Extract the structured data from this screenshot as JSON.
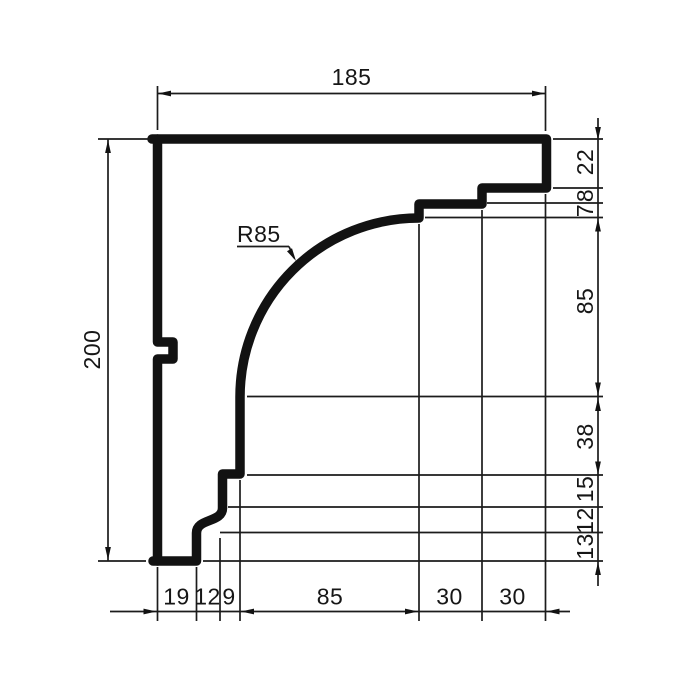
{
  "drawing": {
    "kind": "technical cross-section profile (cornice/moulding) with chain dimensions",
    "colors": {
      "line": "#121212",
      "background": "#ffffff"
    },
    "dimensions": {
      "total_width": 185,
      "total_height": 200,
      "radius": 85,
      "right_segments_top_to_bottom": [
        22,
        8,
        7,
        85,
        38,
        15,
        12,
        13
      ],
      "bottom_segments_left_to_right": [
        19,
        12,
        9,
        85,
        30,
        30
      ]
    }
  },
  "labels": {
    "width_total": "185",
    "height_total": "200",
    "radius": "R85",
    "right_chain": {
      "v22": "22",
      "v8": "8",
      "v7": "7",
      "v85": "85",
      "v38": "38",
      "v15": "15",
      "v12": "12",
      "v13": "13"
    },
    "bottom_chain": {
      "v19": "19",
      "v12": "12",
      "v9": "9",
      "v85": "85",
      "v30a": "30",
      "v30b": "30"
    }
  }
}
